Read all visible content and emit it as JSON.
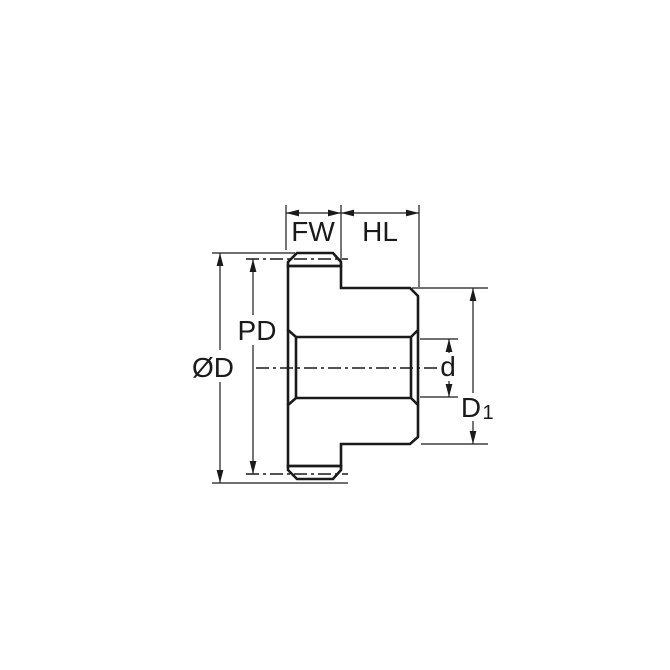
{
  "drawing": {
    "kind": "spur-gear-hub-cross-section",
    "labels": {
      "face_width": "FW",
      "hub_length": "HL",
      "pitch_diameter": "PD",
      "outer_diameter": "ØD",
      "bore_diameter": "d",
      "hub_diameter_base": "D",
      "hub_diameter_sub": "1"
    },
    "colors": {
      "part_fill": "#CAE9F9",
      "line": "#1A1A1A",
      "background": "#FFFFFF"
    }
  }
}
